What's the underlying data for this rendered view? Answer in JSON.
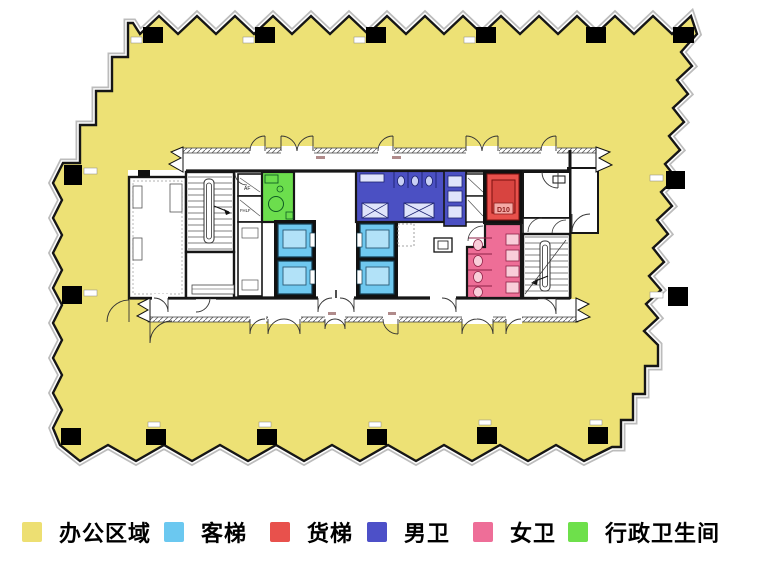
{
  "plan": {
    "freight_car_tag": "D10",
    "shaft_label_top": "AF",
    "shaft_label_bottom": "FHLF",
    "colors": {
      "office": "#EDE175",
      "passenger_elevator": "#6FC8EF",
      "passenger_elevator_inner": "#B2E2F8",
      "freight_elevator": "#E8514C",
      "freight_elevator_car": "#D84440",
      "mens_restroom": "#4B50C3",
      "womens_restroom": "#EE6E97",
      "exec_restroom": "#6CDE4D",
      "wall": "#161616"
    }
  },
  "legend": {
    "items": [
      {
        "id": "office",
        "label": "办公区域",
        "color": "#EDDF72"
      },
      {
        "id": "passenger-elevator",
        "label": "客梯",
        "color": "#6BC8F0"
      },
      {
        "id": "freight-elevator",
        "label": "货梯",
        "color": "#E8514C"
      },
      {
        "id": "mens-restroom",
        "label": "男卫",
        "color": "#4D50C8"
      },
      {
        "id": "womens-restroom",
        "label": "女卫",
        "color": "#EE6E98"
      },
      {
        "id": "exec-restroom",
        "label": "行政卫生间",
        "color": "#6EE04B"
      }
    ]
  }
}
